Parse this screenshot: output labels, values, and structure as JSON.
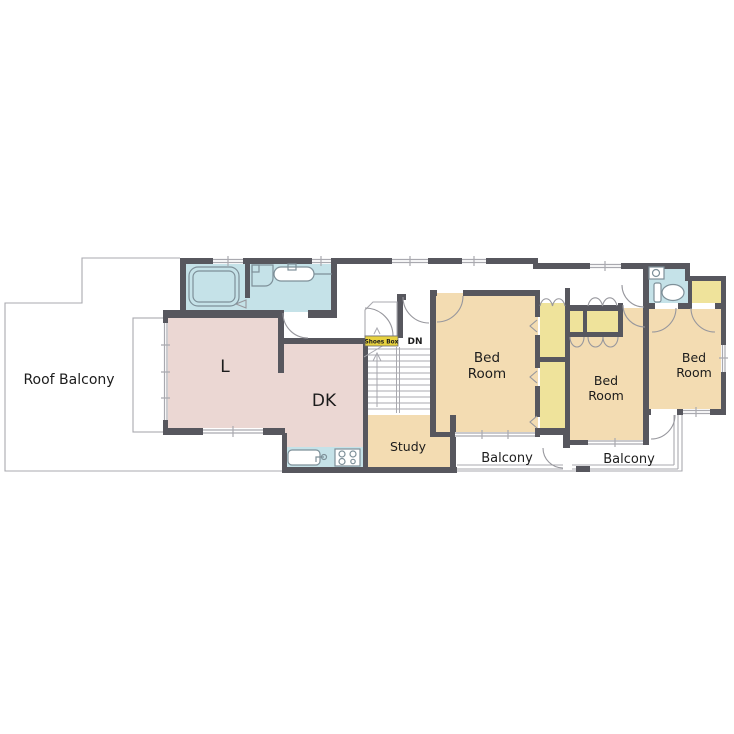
{
  "floorplan": {
    "title": "Second floor plan",
    "labels": {
      "roof_balcony": "Roof Balcony",
      "living": "L",
      "dining_kitchen": "DK",
      "study": "Study",
      "bedroom_line1": "Bed",
      "bedroom_line2": "Room",
      "balcony_left": "Balcony",
      "balcony_right": "Balcony",
      "shoes_box": "Shoes Box",
      "stairs_down": "DN"
    },
    "colors": {
      "wall": "#57575e",
      "ldk_pink": "#ebd7d3",
      "room_beige": "#f3dcb2",
      "closet_yellow": "#efe39b",
      "label_yellow": "#e8d23f",
      "water_blue": "#c5e2e8",
      "thin": "#a9a9af",
      "door": "#97979d",
      "fixture": "#7e9099",
      "text": "#1c1c1c"
    }
  }
}
